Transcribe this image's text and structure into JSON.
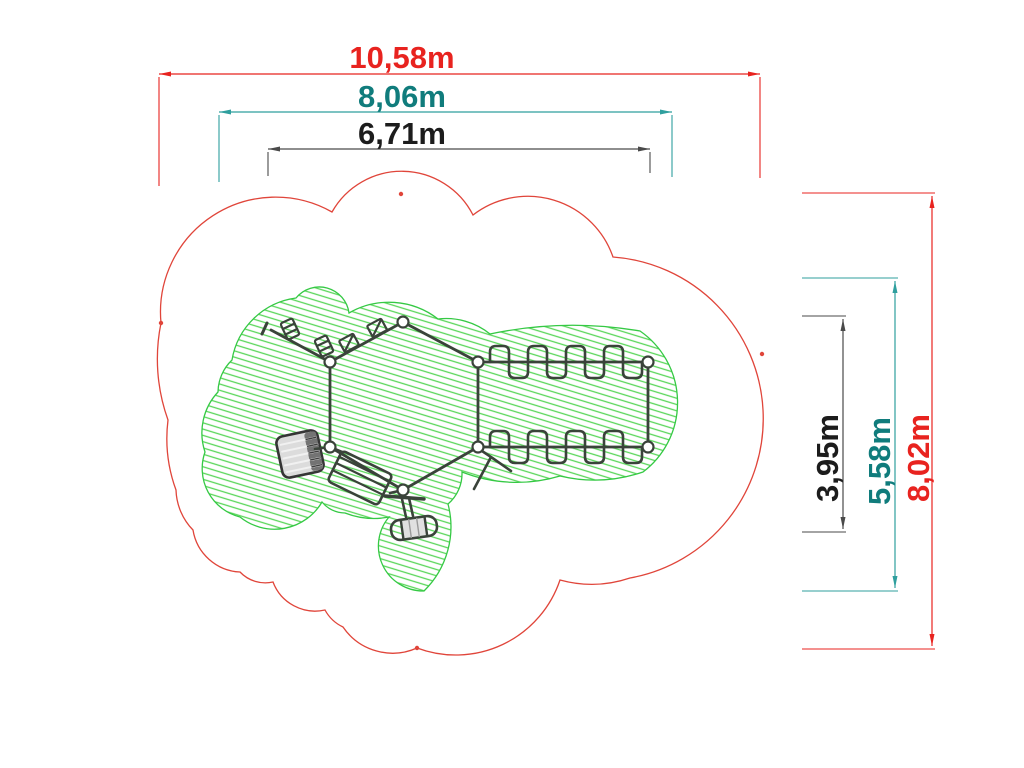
{
  "drawing": {
    "type": "playground-equipment-plan",
    "colors": {
      "safety_zone_red": "#e0453a",
      "dimension_red": "#e8231f",
      "dimension_teal": "#107c7c",
      "dimension_teal_line": "#2f9f9e",
      "dimension_black": "#1c1c1c",
      "play_area_green": "#35c944",
      "hatch_green": "#5ad65a",
      "equipment_dark": "#3a433a"
    },
    "dimensions": {
      "horizontal": [
        {
          "id": "safety-zone-width",
          "label": "10,58m",
          "color": "#e8231f"
        },
        {
          "id": "play-area-width",
          "label": "8,06m",
          "color": "#107c7c"
        },
        {
          "id": "equipment-width",
          "label": "6,71m",
          "color": "#1c1c1c"
        }
      ],
      "vertical": [
        {
          "id": "equipment-height",
          "label": "3,95m",
          "color": "#1c1c1c"
        },
        {
          "id": "play-area-height",
          "label": "5,58m",
          "color": "#107c7c"
        },
        {
          "id": "safety-zone-height",
          "label": "8,02m",
          "color": "#e8231f"
        }
      ]
    }
  }
}
